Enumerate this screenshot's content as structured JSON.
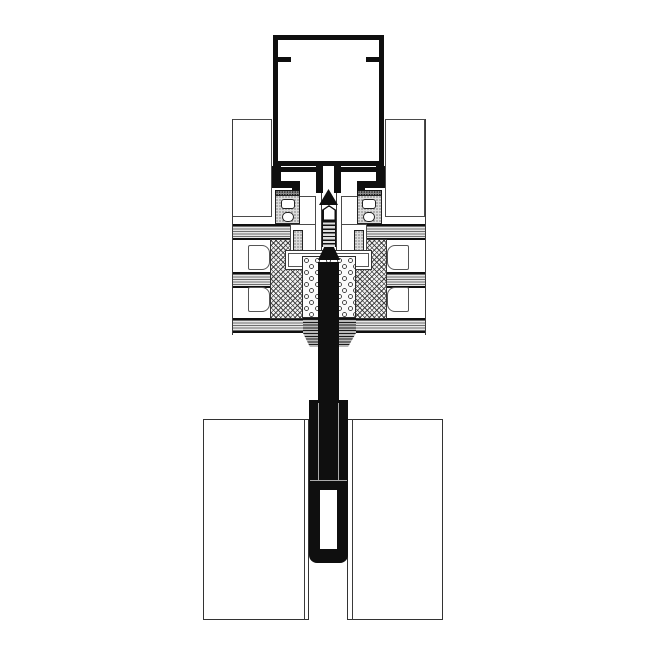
{
  "page": {
    "kind": "technical-section-drawing",
    "visible_text": [],
    "background": "#ffffff"
  },
  "colors": {
    "profile_black": "#0f0f0f",
    "thin_line": "#4a4a4a",
    "glass_fill": "#e6e6e6",
    "hatch_line": "#2d2d2d",
    "gasket_fill": "#dcdcdc",
    "sealant_fill": "#b9b9b9",
    "paper": "#ffffff"
  },
  "components": {
    "mullion_box": "hollow-aluminium-mullion-profile",
    "screw": "fixing-screw-in-central-channel",
    "hooks": "pressure-profile-clip-hooks",
    "gasket_towers": "epdm-glazing-gaskets-with-chambers",
    "upper_panels": "upper-infill-panels",
    "glass_bands": "insulating-glass-unit-panes-in-section",
    "spacers": "edge-spacer-bars-crosshatched",
    "spacer_cavities": "spacer-hollow-chambers",
    "silicone": "structural-silicone-stipple-fill",
    "sealant_joint": "weather-seal-joint",
    "toggle": "black-toggle-anchor-profile",
    "lower_panels": "lower-glass-panels-elevation"
  }
}
